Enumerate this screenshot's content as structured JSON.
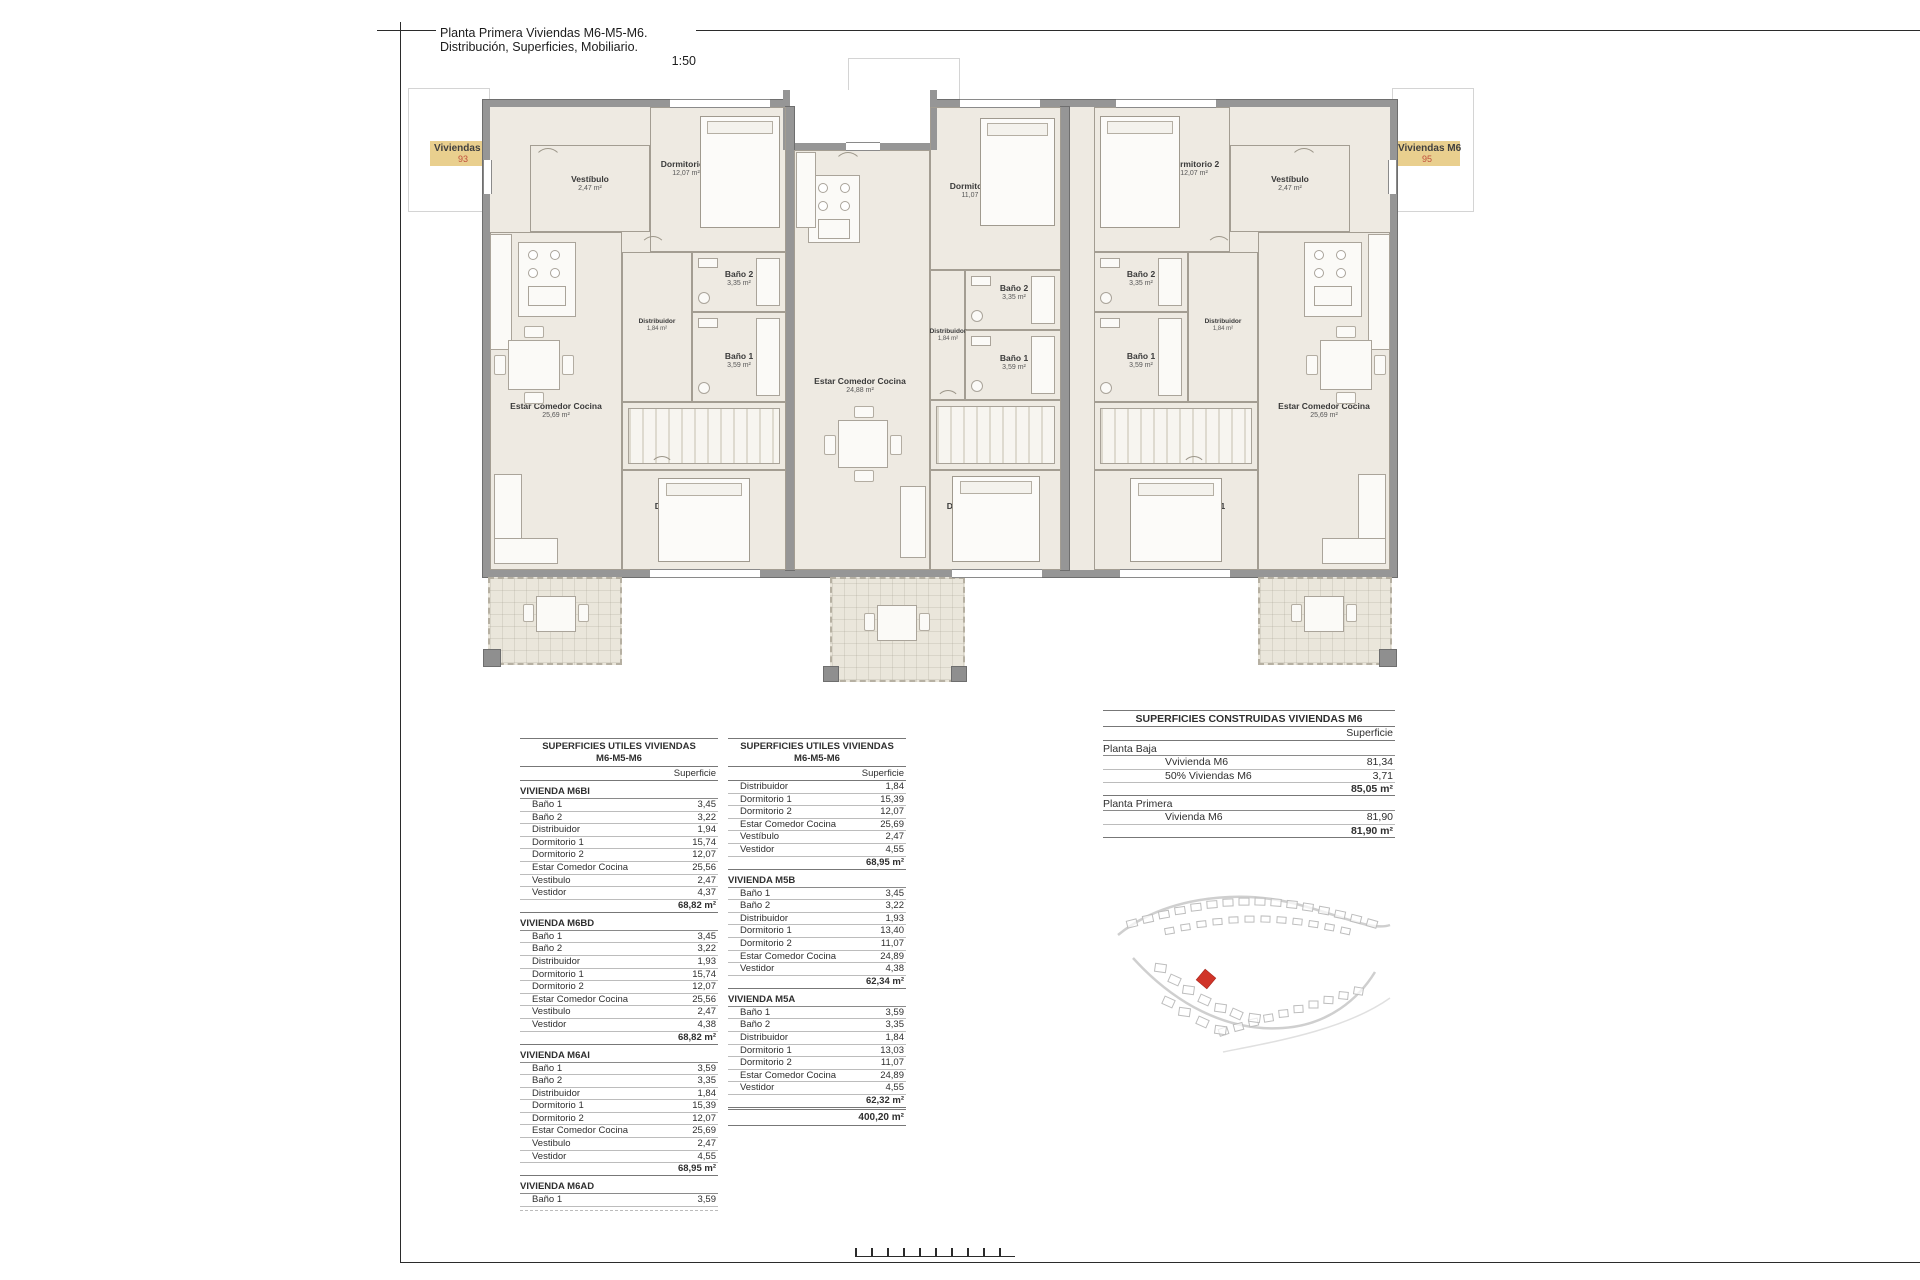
{
  "title": {
    "line1": "Planta Primera Viviendas M6-M5-M6. Distribución, Superficies, Mobiliario.",
    "scale": "1:50"
  },
  "unit_tags": [
    {
      "label": "Viviendas M6",
      "number": "93"
    },
    {
      "label": "Viviendas M5",
      "number": "94"
    },
    {
      "label": "Viviendas M6",
      "number": "95"
    }
  ],
  "colors": {
    "tag_bg": "#e9cf8e",
    "tag_number": "#c0503c",
    "plot_red": "#d03428",
    "wall_gray": "#969696",
    "floor": "#eeeae2"
  },
  "floor_plan": {
    "rooms": {
      "l_vestibulo": {
        "name": "Vestíbulo",
        "area": "2,47 m²"
      },
      "l_dorm2": {
        "name": "Dormitorio 2",
        "area": "12,07 m²"
      },
      "l_bano2": {
        "name": "Baño 2",
        "area": "3,35 m²"
      },
      "l_distribuidor": {
        "name": "Distribuidor",
        "area": "1,84 m²"
      },
      "l_bano1": {
        "name": "Baño 1",
        "area": "3,59 m²"
      },
      "l_vestidor": {
        "name": "Vestidor",
        "area": "4,55 m²"
      },
      "l_dorm1": {
        "name": "Dormitorio 1",
        "area": "15,39 m²"
      },
      "l_estar": {
        "name": "Estar Comedor Cocina",
        "area": "25,69 m²"
      },
      "l_terraza": {
        "name": "Terraza",
        "area": "7,34 m²"
      },
      "c_estar": {
        "name": "Estar Comedor Cocina",
        "area": "24,88 m²"
      },
      "c_dorm2": {
        "name": "Dormitorio 2",
        "area": "11,07 m²"
      },
      "c_bano2": {
        "name": "Baño 2",
        "area": "3,35 m²"
      },
      "c_distribuidor": {
        "name": "Distribuidor",
        "area": "1,84 m²"
      },
      "c_bano1": {
        "name": "Baño 1",
        "area": "3,59 m²"
      },
      "c_vestidor": {
        "name": "Vestidor",
        "area": "4,55 m²"
      },
      "c_dorm1": {
        "name": "Dormitorio 1",
        "area": "13,03 m²"
      },
      "c_terraza": {
        "name": "Terraza",
        "area": "7,91 m²"
      },
      "r_dorm2": {
        "name": "Dormitorio 2",
        "area": "12,07 m²"
      },
      "r_bano2": {
        "name": "Baño 2",
        "area": "3,35 m²"
      },
      "r_distribuidor": {
        "name": "Distribuidor",
        "area": "1,84 m²"
      },
      "r_bano1": {
        "name": "Baño 1",
        "area": "3,59 m²"
      },
      "r_vestidor": {
        "name": "Vestidor",
        "area": "4,55 m²"
      },
      "r_dorm1": {
        "name": "Dormitorio 1",
        "area": "15,39 m²"
      },
      "r_estar": {
        "name": "Estar Comedor Cocina",
        "area": "25,69 m²"
      },
      "r_vestibulo": {
        "name": "Vestíbulo",
        "area": "2,47 m²"
      },
      "r_terraza": {
        "name": "Terraza",
        "area": "7,34 m²"
      }
    }
  },
  "surface_tables": {
    "left": {
      "title_line1": "SUPERFICIES UTILES VIVIENDAS",
      "title_line2": "M6-M5-M6",
      "col_header": "Superficie",
      "sections": [
        {
          "heading": "VIVIENDA M6BI",
          "rows": [
            [
              "Baño 1",
              "3,45"
            ],
            [
              "Baño 2",
              "3,22"
            ],
            [
              "Distribuidor",
              "1,94"
            ],
            [
              "Dormitorio 1",
              "15,74"
            ],
            [
              "Dormitorio 2",
              "12,07"
            ],
            [
              "Estar Comedor Cocina",
              "25,56"
            ],
            [
              "Vestibulo",
              "2,47"
            ],
            [
              "Vestidor",
              "4,37"
            ]
          ],
          "subtotal": "68,82 m²"
        },
        {
          "heading": "VIVIENDA M6BD",
          "rows": [
            [
              "Baño 1",
              "3,45"
            ],
            [
              "Baño 2",
              "3,22"
            ],
            [
              "Distribuidor",
              "1,93"
            ],
            [
              "Dormitorio 1",
              "15,74"
            ],
            [
              "Dormitorio 2",
              "12,07"
            ],
            [
              "Estar Comedor Cocina",
              "25,56"
            ],
            [
              "Vestibulo",
              "2,47"
            ],
            [
              "Vestidor",
              "4,38"
            ]
          ],
          "subtotal": "68,82 m²"
        },
        {
          "heading": "VIVIENDA M6AI",
          "rows": [
            [
              "Baño 1",
              "3,59"
            ],
            [
              "Baño 2",
              "3,35"
            ],
            [
              "Distribuidor",
              "1,84"
            ],
            [
              "Dormitorio 1",
              "15,39"
            ],
            [
              "Dormitorio 2",
              "12,07"
            ],
            [
              "Estar Comedor Cocina",
              "25,69"
            ],
            [
              "Vestibulo",
              "2,47"
            ],
            [
              "Vestidor",
              "4,55"
            ]
          ],
          "subtotal": "68,95 m²"
        },
        {
          "heading": "VIVIENDA M6AD",
          "rows": [
            [
              "Baño 1",
              "3,59"
            ]
          ],
          "subtotal": null
        }
      ]
    },
    "middle": {
      "title_line1": "SUPERFICIES UTILES VIVIENDAS",
      "title_line2": "M6-M5-M6",
      "col_header": "Superficie",
      "sections": [
        {
          "heading": null,
          "rows": [
            [
              "Distribuidor",
              "1,84"
            ],
            [
              "Dormitorio 1",
              "15,39"
            ],
            [
              "Dormitorio 2",
              "12,07"
            ],
            [
              "Estar Comedor Cocina",
              "25,69"
            ],
            [
              "Vestíbulo",
              "2,47"
            ],
            [
              "Vestidor",
              "4,55"
            ]
          ],
          "subtotal": "68,95 m²"
        },
        {
          "heading": "VIVIENDA M5B",
          "rows": [
            [
              "Baño 1",
              "3,45"
            ],
            [
              "Baño 2",
              "3,22"
            ],
            [
              "Distribuidor",
              "1,93"
            ],
            [
              "Dormitorio 1",
              "13,40"
            ],
            [
              "Dormitorio 2",
              "11,07"
            ],
            [
              "Estar Comedor Cocina",
              "24,89"
            ],
            [
              "Vestidor",
              "4,38"
            ]
          ],
          "subtotal": "62,34 m²"
        },
        {
          "heading": "VIVIENDA M5A",
          "rows": [
            [
              "Baño 1",
              "3,59"
            ],
            [
              "Baño 2",
              "3,35"
            ],
            [
              "Distribuidor",
              "1,84"
            ],
            [
              "Dormitorio 1",
              "13,03"
            ],
            [
              "Dormitorio 2",
              "11,07"
            ],
            [
              "Estar Comedor Cocina",
              "24,89"
            ],
            [
              "Vestidor",
              "4,55"
            ]
          ],
          "subtotal": "62,32 m²"
        }
      ],
      "grand_total": "400,20 m²"
    },
    "right": {
      "title": "SUPERFICIES CONSTRUIDAS VIVIENDAS M6",
      "col_header": "Superficie",
      "groups": [
        {
          "heading": "Planta Baja",
          "rows": [
            [
              "Vvivienda M6",
              "81,34"
            ],
            [
              "50% Viviendas M6",
              "3,71"
            ]
          ],
          "subtotal": "85,05 m²"
        },
        {
          "heading": "Planta Primera",
          "rows": [
            [
              "Vivienda M6",
              "81,90"
            ]
          ],
          "subtotal": "81,90 m²"
        }
      ]
    }
  }
}
